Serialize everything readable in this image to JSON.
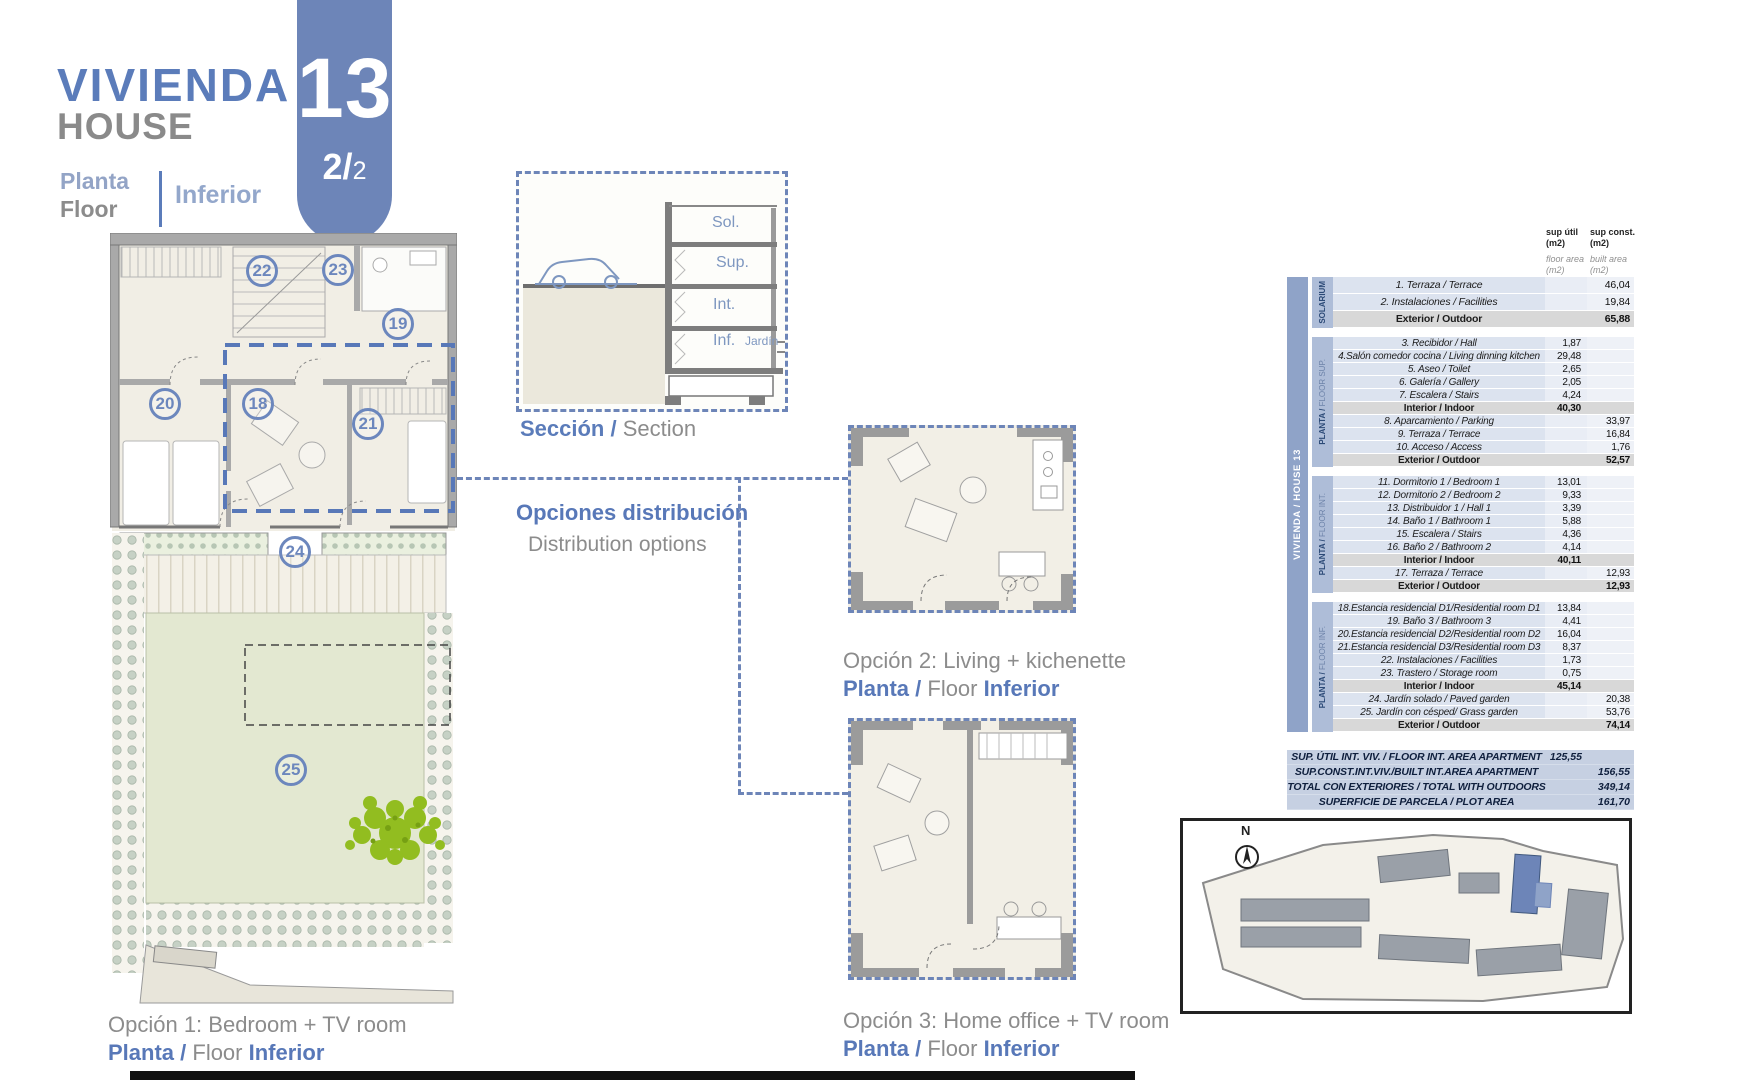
{
  "header": {
    "title_es": "VIVIENDA",
    "title_en": "HOUSE",
    "badge_number": "13",
    "badge_page": "2/",
    "badge_page_small": "2",
    "floor_es": "Planta",
    "floor_en": "Floor",
    "floor_value": "Inferior"
  },
  "section_box": {
    "labels": {
      "sol": "Sol.",
      "sup": "Sup.",
      "int": "Int.",
      "inf": "Inf.",
      "garden": "Jardín"
    },
    "caption_es": "Sección /",
    "caption_en": "Section"
  },
  "distribution": {
    "title_es": "Opciones distribución",
    "title_en": "Distribution options"
  },
  "options": [
    {
      "caption": "Opción 1: Bedroom + TV room",
      "floor_es": "Planta /",
      "floor_en": "Floor",
      "floor_value": "Inferior"
    },
    {
      "caption": "Opción 2: Living + kichenette",
      "floor_es": "Planta /",
      "floor_en": "Floor",
      "floor_value": "Inferior"
    },
    {
      "caption": "Opción 3: Home office + TV room",
      "floor_es": "Planta /",
      "floor_en": "Floor",
      "floor_value": "Inferior"
    }
  ],
  "plan": {
    "badges": {
      "b18": "18",
      "b19": "19",
      "b20": "20",
      "b21": "21",
      "b22": "22",
      "b23": "23",
      "b24": "24",
      "b25": "25"
    }
  },
  "table": {
    "col1_header": "sup útil",
    "col1_unit": "(m2)",
    "col1_sub": "floor area (m2)",
    "col2_header": "sup const.",
    "col2_unit": "(m2)",
    "col2_sub": "built area (m2)",
    "side_label": "VIVIENDA / HOUSE 13",
    "sections": [
      {
        "name_strong": "SOLARIUM",
        "name_light": "",
        "rows": [
          {
            "label": "1. Terraza / Terrace",
            "c1": "",
            "c2": "46,04"
          },
          {
            "label": "2. Instalaciones / Facilities",
            "c1": "",
            "c2": "19,84"
          },
          {
            "label": "Exterior / Outdoor",
            "c1": "",
            "c2": "65,88",
            "sub": true
          }
        ]
      },
      {
        "name_strong": "PLANTA /",
        "name_light": "FLOOR SUP.",
        "rows": [
          {
            "label": "3. Recibidor / Hall",
            "c1": "1,87",
            "c2": ""
          },
          {
            "label": "4.Salón comedor cocina / Living dinning kitchen",
            "c1": "29,48",
            "c2": ""
          },
          {
            "label": "5. Aseo / Toilet",
            "c1": "2,65",
            "c2": ""
          },
          {
            "label": "6. Galería / Gallery",
            "c1": "2,05",
            "c2": ""
          },
          {
            "label": "7. Escalera / Stairs",
            "c1": "4,24",
            "c2": ""
          },
          {
            "label": "Interior / Indoor",
            "c1": "40,30",
            "c2": "",
            "sub": true
          },
          {
            "label": "8. Aparcamiento / Parking",
            "c1": "",
            "c2": "33,97"
          },
          {
            "label": "9. Terraza / Terrace",
            "c1": "",
            "c2": "16,84"
          },
          {
            "label": "10. Acceso / Access",
            "c1": "",
            "c2": "1,76"
          },
          {
            "label": "Exterior / Outdoor",
            "c1": "",
            "c2": "52,57",
            "sub": true
          }
        ]
      },
      {
        "name_strong": "PLANTA /",
        "name_light": "FLOOR INT.",
        "rows": [
          {
            "label": "11. Dormitorio 1 / Bedroom 1",
            "c1": "13,01",
            "c2": ""
          },
          {
            "label": "12. Dormitorio 2 / Bedroom 2",
            "c1": "9,33",
            "c2": ""
          },
          {
            "label": "13. Distribuidor 1 / Hall 1",
            "c1": "3,39",
            "c2": ""
          },
          {
            "label": "14. Baño 1 / Bathroom 1",
            "c1": "5,88",
            "c2": ""
          },
          {
            "label": "15. Escalera / Stairs",
            "c1": "4,36",
            "c2": ""
          },
          {
            "label": "16. Baño 2 / Bathroom 2",
            "c1": "4,14",
            "c2": ""
          },
          {
            "label": "Interior / Indoor",
            "c1": "40,11",
            "c2": "",
            "sub": true
          },
          {
            "label": "17. Terraza / Terrace",
            "c1": "",
            "c2": "12,93"
          },
          {
            "label": "Exterior / Outdoor",
            "c1": "",
            "c2": "12,93",
            "sub": true
          }
        ]
      },
      {
        "name_strong": "PLANTA /",
        "name_light": "FLOOR INF.",
        "rows": [
          {
            "label": "18.Estancia residencial D1/Residential room D1",
            "c1": "13,84",
            "c2": ""
          },
          {
            "label": "19. Baño 3 / Bathroom 3",
            "c1": "4,41",
            "c2": ""
          },
          {
            "label": "20.Estancia residencial D2/Residential room D2",
            "c1": "16,04",
            "c2": ""
          },
          {
            "label": "21.Estancia residencial D3/Residential room D3",
            "c1": "8,37",
            "c2": ""
          },
          {
            "label": "22. Instalaciones / Facilities",
            "c1": "1,73",
            "c2": ""
          },
          {
            "label": "23. Trastero / Storage room",
            "c1": "0,75",
            "c2": ""
          },
          {
            "label": "Interior / Indoor",
            "c1": "45,14",
            "c2": "",
            "sub": true
          },
          {
            "label": "24. Jardín solado / Paved garden",
            "c1": "",
            "c2": "20,38"
          },
          {
            "label": "25. Jardín con césped/ Grass garden",
            "c1": "",
            "c2": "53,76"
          },
          {
            "label": "Exterior / Outdoor",
            "c1": "",
            "c2": "74,14",
            "sub": true
          }
        ]
      }
    ],
    "summary": [
      {
        "label": "SUP. ÚTIL INT. VIV. / FLOOR INT. AREA APARTMENT",
        "c1": "125,55",
        "c2": ""
      },
      {
        "label": "SUP.CONST.INT.VIV./BUILT INT.AREA APARTMENT",
        "c1": "",
        "c2": "156,55"
      },
      {
        "label": "TOTAL CON EXTERIORES / TOTAL WITH OUTDOORS",
        "c1": "",
        "c2": "349,14"
      },
      {
        "label": "SUPERFICIE DE PARCELA / PLOT AREA",
        "c1": "",
        "c2": "161,70"
      }
    ]
  },
  "site_plan": {
    "north_label": "N"
  },
  "colors": {
    "accent_blue": "#5b7cba",
    "badge_blue": "#6d85b8",
    "gray_text": "#8c8c8c",
    "table_bar": "#8fa3c8",
    "section_bar": "#aebdd8",
    "row_bg": "#dce3ef",
    "subtotal_bg": "#d8d8d8",
    "summary_bg": "#c6d0e2",
    "garden_green": "#e3e8d1",
    "tree_green": "#92bd20"
  }
}
